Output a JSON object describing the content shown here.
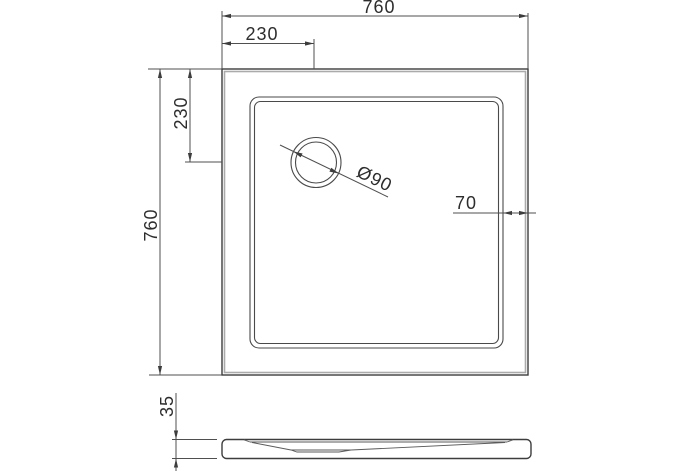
{
  "colors": {
    "line": "#3d3d3d",
    "thin_line": "#4f4f4f",
    "shadow_line": "#ababab",
    "text": "#2d2d2d",
    "background": "#ffffff"
  },
  "plan_view": {
    "width_label": "760",
    "height_label": "760",
    "drain_offset_x_label": "230",
    "drain_offset_y_label": "230",
    "drain_diameter_label": "Ø90",
    "rim_width_label": "70"
  },
  "side_view": {
    "depth_label": "35"
  }
}
